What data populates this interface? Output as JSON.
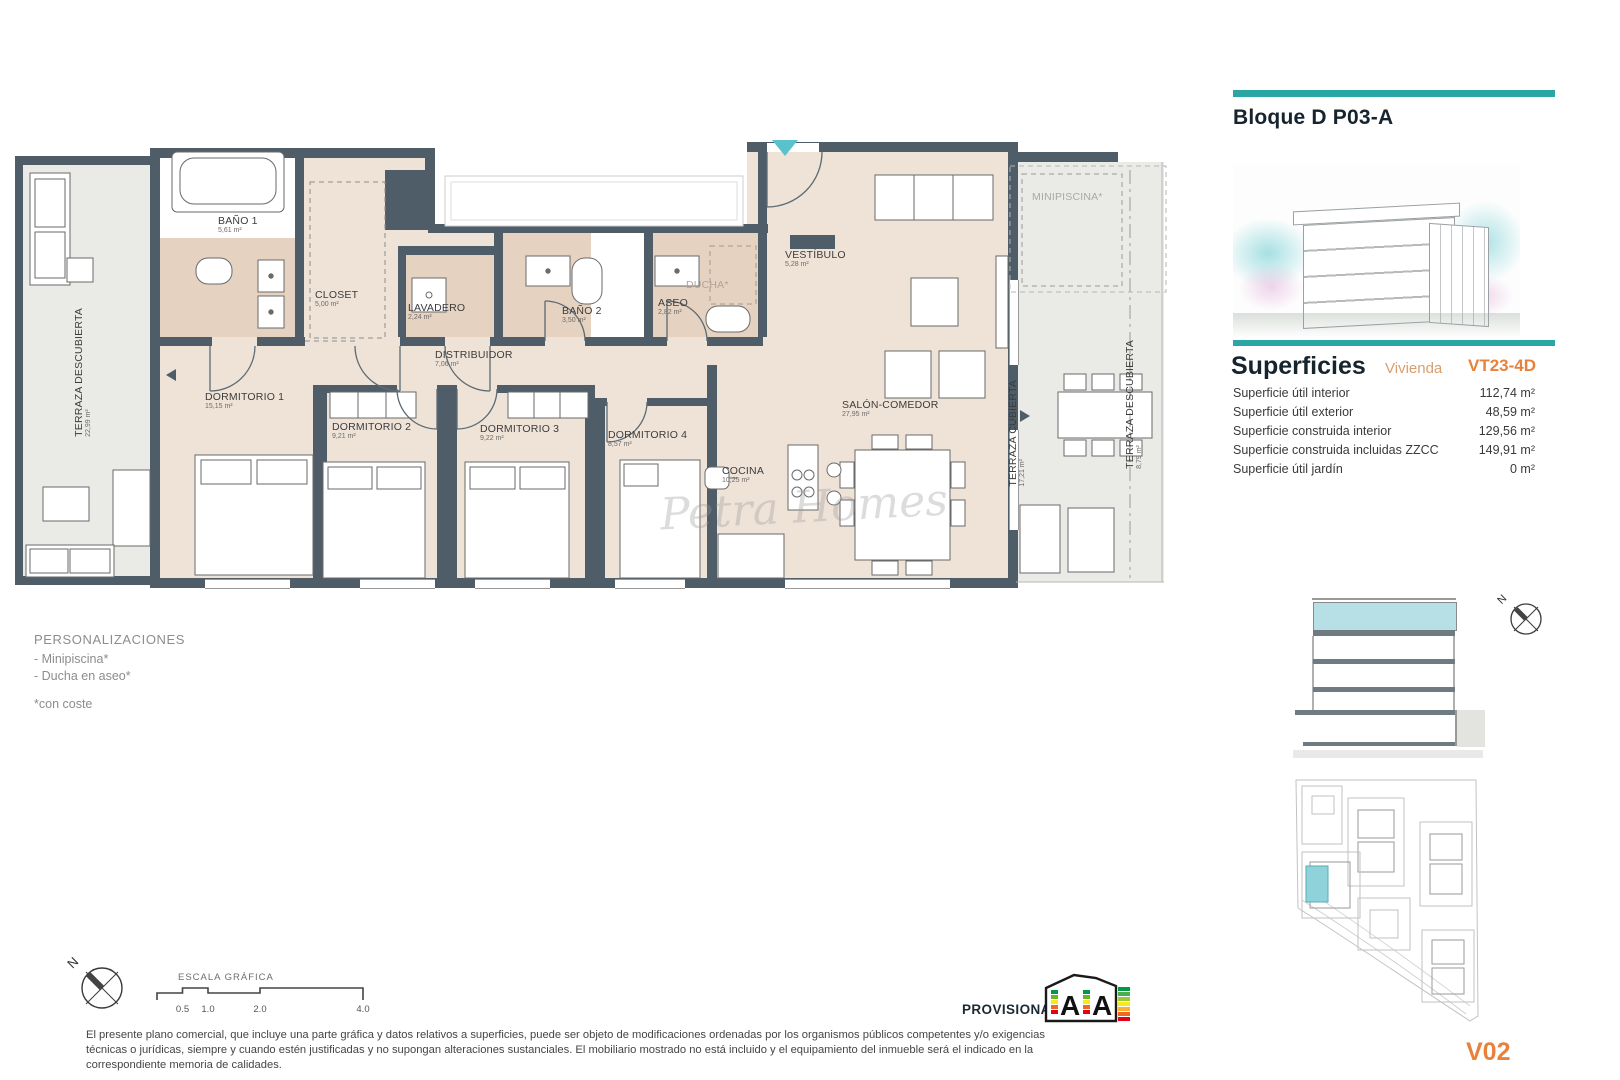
{
  "plan": {
    "watermark": "Petra Homes",
    "rooms": [
      {
        "id": "terraza-descubierta-left",
        "label": "TERRAZA DESCUBIERTA",
        "area": "22,99 m²"
      },
      {
        "id": "bano1",
        "label": "BAÑO 1",
        "area": "5,61 m²"
      },
      {
        "id": "closet",
        "label": "CLOSET",
        "area": "5,00 m²"
      },
      {
        "id": "lavadero",
        "label": "LAVADERO",
        "area": "2,24 m²"
      },
      {
        "id": "bano2",
        "label": "BAÑO 2",
        "area": "3,50 m²"
      },
      {
        "id": "aseo",
        "label": "ASEO",
        "area": "2,82 m²"
      },
      {
        "id": "ducha",
        "label": "DUCHA*",
        "area": ""
      },
      {
        "id": "vestibulo",
        "label": "VESTÍBULO",
        "area": "5,28 m²"
      },
      {
        "id": "distribuidor",
        "label": "DISTRIBUIDOR",
        "area": "7,06 m²"
      },
      {
        "id": "dormitorio1",
        "label": "DORMITORIO 1",
        "area": "15,15 m²"
      },
      {
        "id": "dormitorio2",
        "label": "DORMITORIO 2",
        "area": "9,21 m²"
      },
      {
        "id": "dormitorio3",
        "label": "DORMITORIO 3",
        "area": "9,22 m²"
      },
      {
        "id": "dormitorio4",
        "label": "DORMITORIO 4",
        "area": "8,57 m²"
      },
      {
        "id": "cocina",
        "label": "COCINA",
        "area": "10,25 m²"
      },
      {
        "id": "salon-comedor",
        "label": "SALÓN-COMEDOR",
        "area": "27,95 m²"
      },
      {
        "id": "minipiscina",
        "label": "MINIPISCINA*",
        "area": ""
      },
      {
        "id": "terraza-cubierta",
        "label": "TERRAZA CUBIERTA",
        "area": "17,21 m²"
      },
      {
        "id": "terraza-descubierta-right",
        "label": "TERRAZA DESCUBIERTA",
        "area": "8,79 m²"
      }
    ]
  },
  "personalizaciones": {
    "title": "PERSONALIZACIONES",
    "items": [
      "- Minipiscina*",
      "- Ducha en aseo*"
    ],
    "footnote": "*con coste"
  },
  "scale_bar": {
    "title": "ESCALA GRÁFICA",
    "ticks": [
      "0.5",
      "1.0",
      "2.0",
      "4.0"
    ],
    "compass_label": "N"
  },
  "footer": {
    "provisional": "PROVISIONAL",
    "energy_letters": [
      "A",
      "A"
    ],
    "disclaimer": "El presente plano comercial, que incluye una parte gráfica y datos relativos a superficies, puede ser objeto de modificaciones ordenadas por los organismos públicos competentes y/o exigencias técnicas o jurídicas, siempre y cuando estén justificadas y no supongan alteraciones sustanciales. El mobiliario mostrado no está incluido y el equipamiento del inmueble será el indicado en la correspondiente memoria de calidades."
  },
  "sidebar": {
    "block_title": "Bloque D P03-A",
    "superficies_title": "Superficies",
    "superficies_type": "Vivienda",
    "unit_code": "VT23-4D",
    "rows": [
      {
        "label": "Superficie útil interior",
        "value": "112,74 m²"
      },
      {
        "label": "Superficie útil exterior",
        "value": "48,59 m²"
      },
      {
        "label": "Superficie construida interior",
        "value": "129,56 m²"
      },
      {
        "label": "Superficie construida incluidas ZZCC",
        "value": "149,91 m²"
      },
      {
        "label": "Superficie útil jardín",
        "value": "0 m²"
      }
    ],
    "version": "V02",
    "section_compass_label": "N"
  },
  "colors": {
    "wall": "#4e5d68",
    "floor": "#efe3d8",
    "wet_floor": "#e6d2c0",
    "terrace": "#eaeae7",
    "teal_accent": "#2aa7a5",
    "orange_accent": "#e8823b",
    "section_highlight": "#b7dfe6"
  }
}
